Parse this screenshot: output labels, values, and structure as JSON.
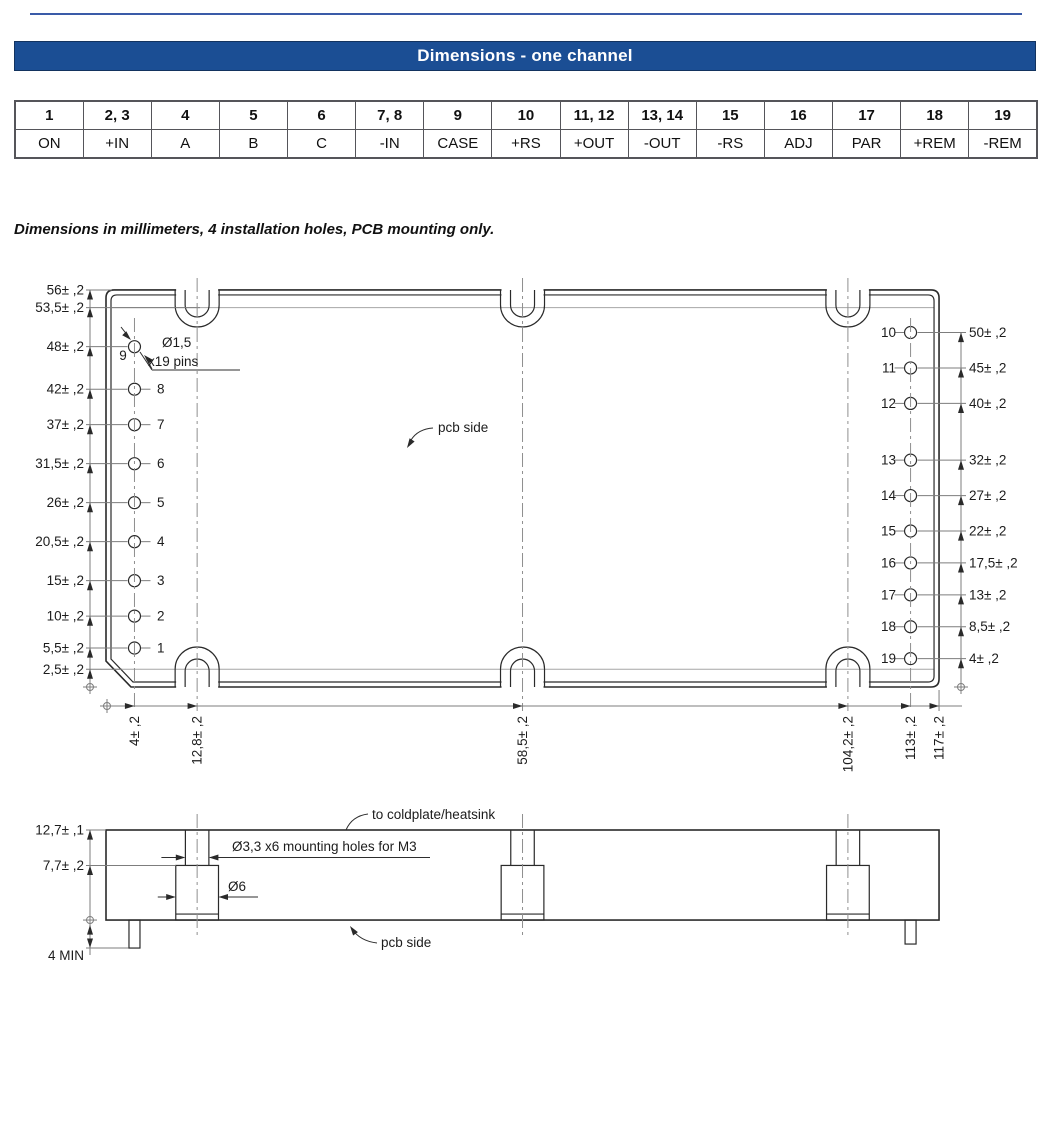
{
  "page": {
    "title": "Dimensions - one channel",
    "note": "Dimensions in millimeters, 4 installation holes, PCB mounting only."
  },
  "pin_table": {
    "pins": [
      "1",
      "2, 3",
      "4",
      "5",
      "6",
      "7, 8",
      "9",
      "10",
      "11, 12",
      "13, 14",
      "15",
      "16",
      "17",
      "18",
      "19"
    ],
    "functions": [
      "ON",
      "+IN",
      "A",
      "B",
      "C",
      "-IN",
      "CASE",
      "+RS",
      "+OUT",
      "-OUT",
      "-RS",
      "ADJ",
      "PAR",
      "+REM",
      "-REM"
    ]
  },
  "top_view": {
    "left_edge_dims": [
      {
        "label": "56± ,2",
        "mm": 56
      },
      {
        "label": "53,5± ,2",
        "mm": 53.5
      },
      {
        "label": "2,5± ,2",
        "mm": 2.5
      }
    ],
    "left_pins": [
      {
        "num": "9",
        "label": "48± ,2",
        "mm": 48
      },
      {
        "num": "8",
        "label": "42± ,2",
        "mm": 42
      },
      {
        "num": "7",
        "label": "37± ,2",
        "mm": 37
      },
      {
        "num": "6",
        "label": "31,5± ,2",
        "mm": 31.5
      },
      {
        "num": "5",
        "label": "26± ,2",
        "mm": 26
      },
      {
        "num": "4",
        "label": "20,5± ,2",
        "mm": 20.5
      },
      {
        "num": "3",
        "label": "15± ,2",
        "mm": 15
      },
      {
        "num": "2",
        "label": "10± ,2",
        "mm": 10
      },
      {
        "num": "1",
        "label": "5,5± ,2",
        "mm": 5.5
      }
    ],
    "right_pins": [
      {
        "num": "10",
        "label": "50± ,2",
        "mm": 50
      },
      {
        "num": "11",
        "label": "45± ,2",
        "mm": 45
      },
      {
        "num": "12",
        "label": "40± ,2",
        "mm": 40
      },
      {
        "num": "13",
        "label": "32± ,2",
        "mm": 32
      },
      {
        "num": "14",
        "label": "27± ,2",
        "mm": 27
      },
      {
        "num": "15",
        "label": "22± ,2",
        "mm": 22
      },
      {
        "num": "16",
        "label": "17,5± ,2",
        "mm": 17.5
      },
      {
        "num": "17",
        "label": "13± ,2",
        "mm": 13
      },
      {
        "num": "18",
        "label": "8,5± ,2",
        "mm": 8.5
      },
      {
        "num": "19",
        "label": "4± ,2",
        "mm": 4
      }
    ],
    "bottom_dims": [
      {
        "label": "4± ,2",
        "mm": 4
      },
      {
        "label": "12,8± ,2",
        "mm": 12.8
      },
      {
        "label": "58,5± ,2",
        "mm": 58.5
      },
      {
        "label": "104,2± ,2",
        "mm": 104.2
      },
      {
        "label": "113± ,2",
        "mm": 113
      },
      {
        "label": "117± ,2",
        "mm": 117
      }
    ],
    "callouts": {
      "pin_dia": "Ø1,5",
      "pin_count": "x19 pins",
      "pcb_side": "pcb side"
    }
  },
  "side_view": {
    "height_dims": [
      {
        "label": "12,7± ,1",
        "mm": 12.7
      },
      {
        "label": "7,7± ,2",
        "mm": 7.7
      }
    ],
    "pin_min": {
      "label": "4 MIN",
      "mm": 4
    },
    "callouts": {
      "coldplate": "to coldplate/heatsink",
      "mount_holes": "Ø3,3 x6 mounting holes for M3",
      "boss": "Ø6",
      "pcb_side": "pcb side"
    }
  },
  "colors": {
    "accent": "#1b4e94",
    "header_text": "#ffffff",
    "rule": "#3a5ba8",
    "table_border": "#55555a",
    "line": "#2a2a2a",
    "dim_line": "#7d7d7d"
  }
}
